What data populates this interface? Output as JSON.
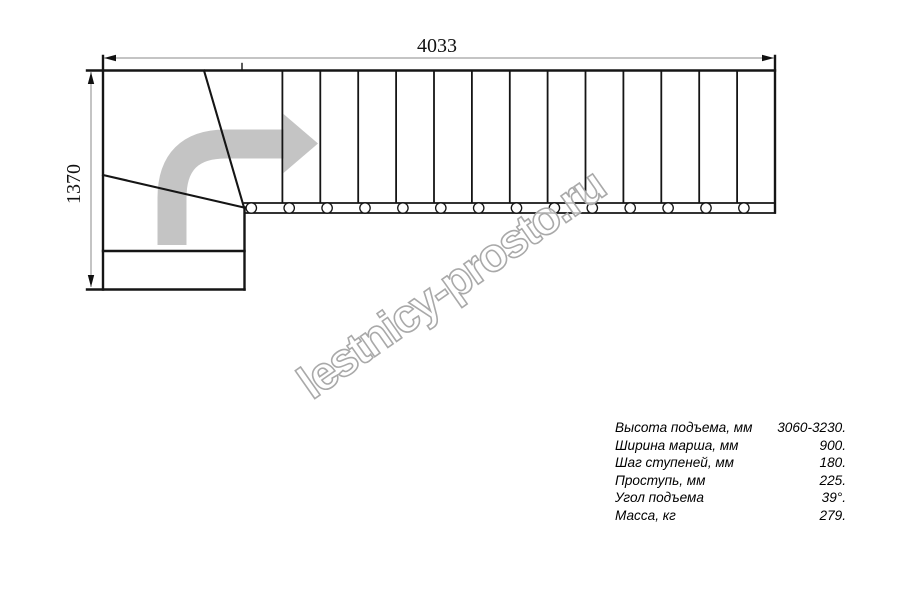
{
  "drawing": {
    "width_dimension": "4033",
    "height_dimension": "1370",
    "tread_count": 14,
    "baluster_count": 14
  },
  "watermark": {
    "text": "lestnicy-prosto.ru"
  },
  "specs": {
    "rows": [
      {
        "label": "Высота подъема, мм",
        "value": "3060-3230."
      },
      {
        "label": "Ширина марша, мм",
        "value": "900."
      },
      {
        "label": "Шаг ступеней, мм",
        "value": "180."
      },
      {
        "label": "Проступь, мм",
        "value": "225."
      },
      {
        "label": "Угол подъема",
        "value": "39°."
      },
      {
        "label": "Масса, кг",
        "value": "279."
      }
    ]
  },
  "colors": {
    "line": "#151515",
    "dimension_line": "#8a8a8a",
    "dimension_text": "#111111",
    "arrow": "#c4c4c4",
    "watermark_stroke": "#a9a9a9",
    "watermark_fill": "#ffffff"
  }
}
